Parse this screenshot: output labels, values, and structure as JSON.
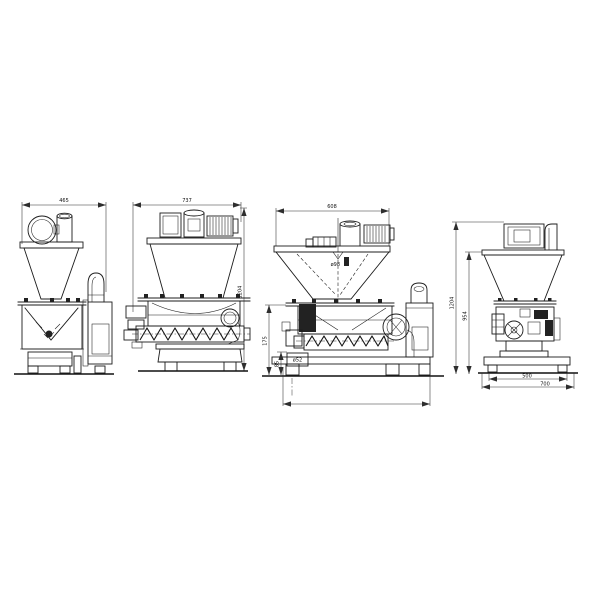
{
  "drawing": {
    "background_color": "#ffffff",
    "line_color": "#1c1c1c"
  },
  "views": {
    "v1": {
      "width": "465"
    },
    "v2": {
      "width": "737",
      "height": "1204"
    },
    "v3": {
      "width": "608",
      "inlet": "ø98",
      "left_height": "175",
      "spout_height": "85",
      "spout_dia": "ø52"
    },
    "v4": {
      "height_outer": "1204",
      "height_inner": "954",
      "base_width": "500",
      "base_overall": "700"
    }
  }
}
